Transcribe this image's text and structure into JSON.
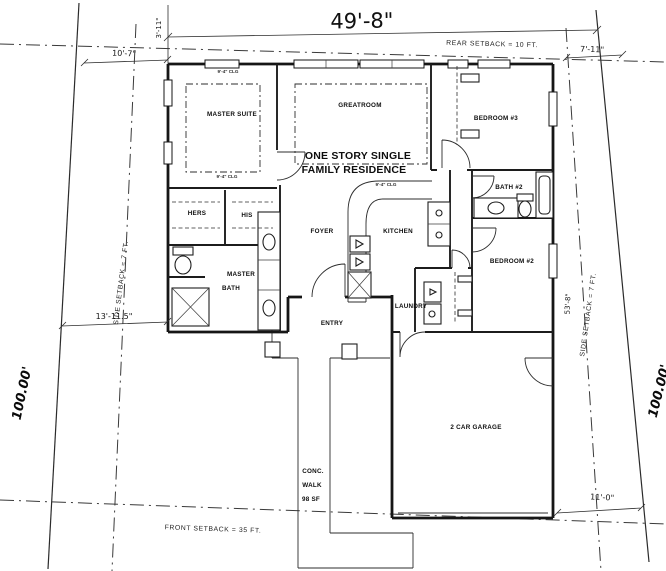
{
  "drawing": {
    "rooms": {
      "master_suite": "MASTER SUITE",
      "greatroom": "GREATROOM",
      "residence_line1": "ONE STORY SINGLE",
      "residence_line2": "FAMILY RESIDENCE",
      "bedroom3": "BEDROOM #3",
      "bath2": "BATH #2",
      "bedroom2": "BEDROOM #2",
      "kitchen": "KITCHEN",
      "foyer": "FOYER",
      "closet_hers": "HERS",
      "closet_his": "HIS",
      "master_bath_line1": "MASTER",
      "master_bath_line2": "BATH",
      "entry": "ENTRY",
      "laundry": "LAUNDRY",
      "garage": "2 CAR GARAGE",
      "walk_line1": "CONC.",
      "walk_line2": "WALK",
      "walk_line3": "98 SF"
    },
    "setbacks": {
      "rear": "REAR SETBACK = 10 FT.",
      "front": "FRONT SETBACK = 35 FT.",
      "side_left": "SIDE SETBACK = 7 FT.",
      "side_right": "SIDE SETBACK = 7 FT."
    },
    "dimensions": {
      "house_width": "49'-8\"",
      "rear_left_offset": "10'-7\"",
      "rear_right_offset": "7'-11\"",
      "rear_top": "3'-11\"",
      "left_side": "13'-11.5\"",
      "right_side_depth": "53'-8\"",
      "garage_side_offset": "11'-0\"",
      "lot_depth_left": "100.00'",
      "lot_depth_right": "100.00'"
    },
    "notes": {
      "clg_master_top": "9'-4\" CLG",
      "clg_master_bottom": "9'-4\" CLG",
      "clg_great": "9'-4\" CLG"
    }
  }
}
